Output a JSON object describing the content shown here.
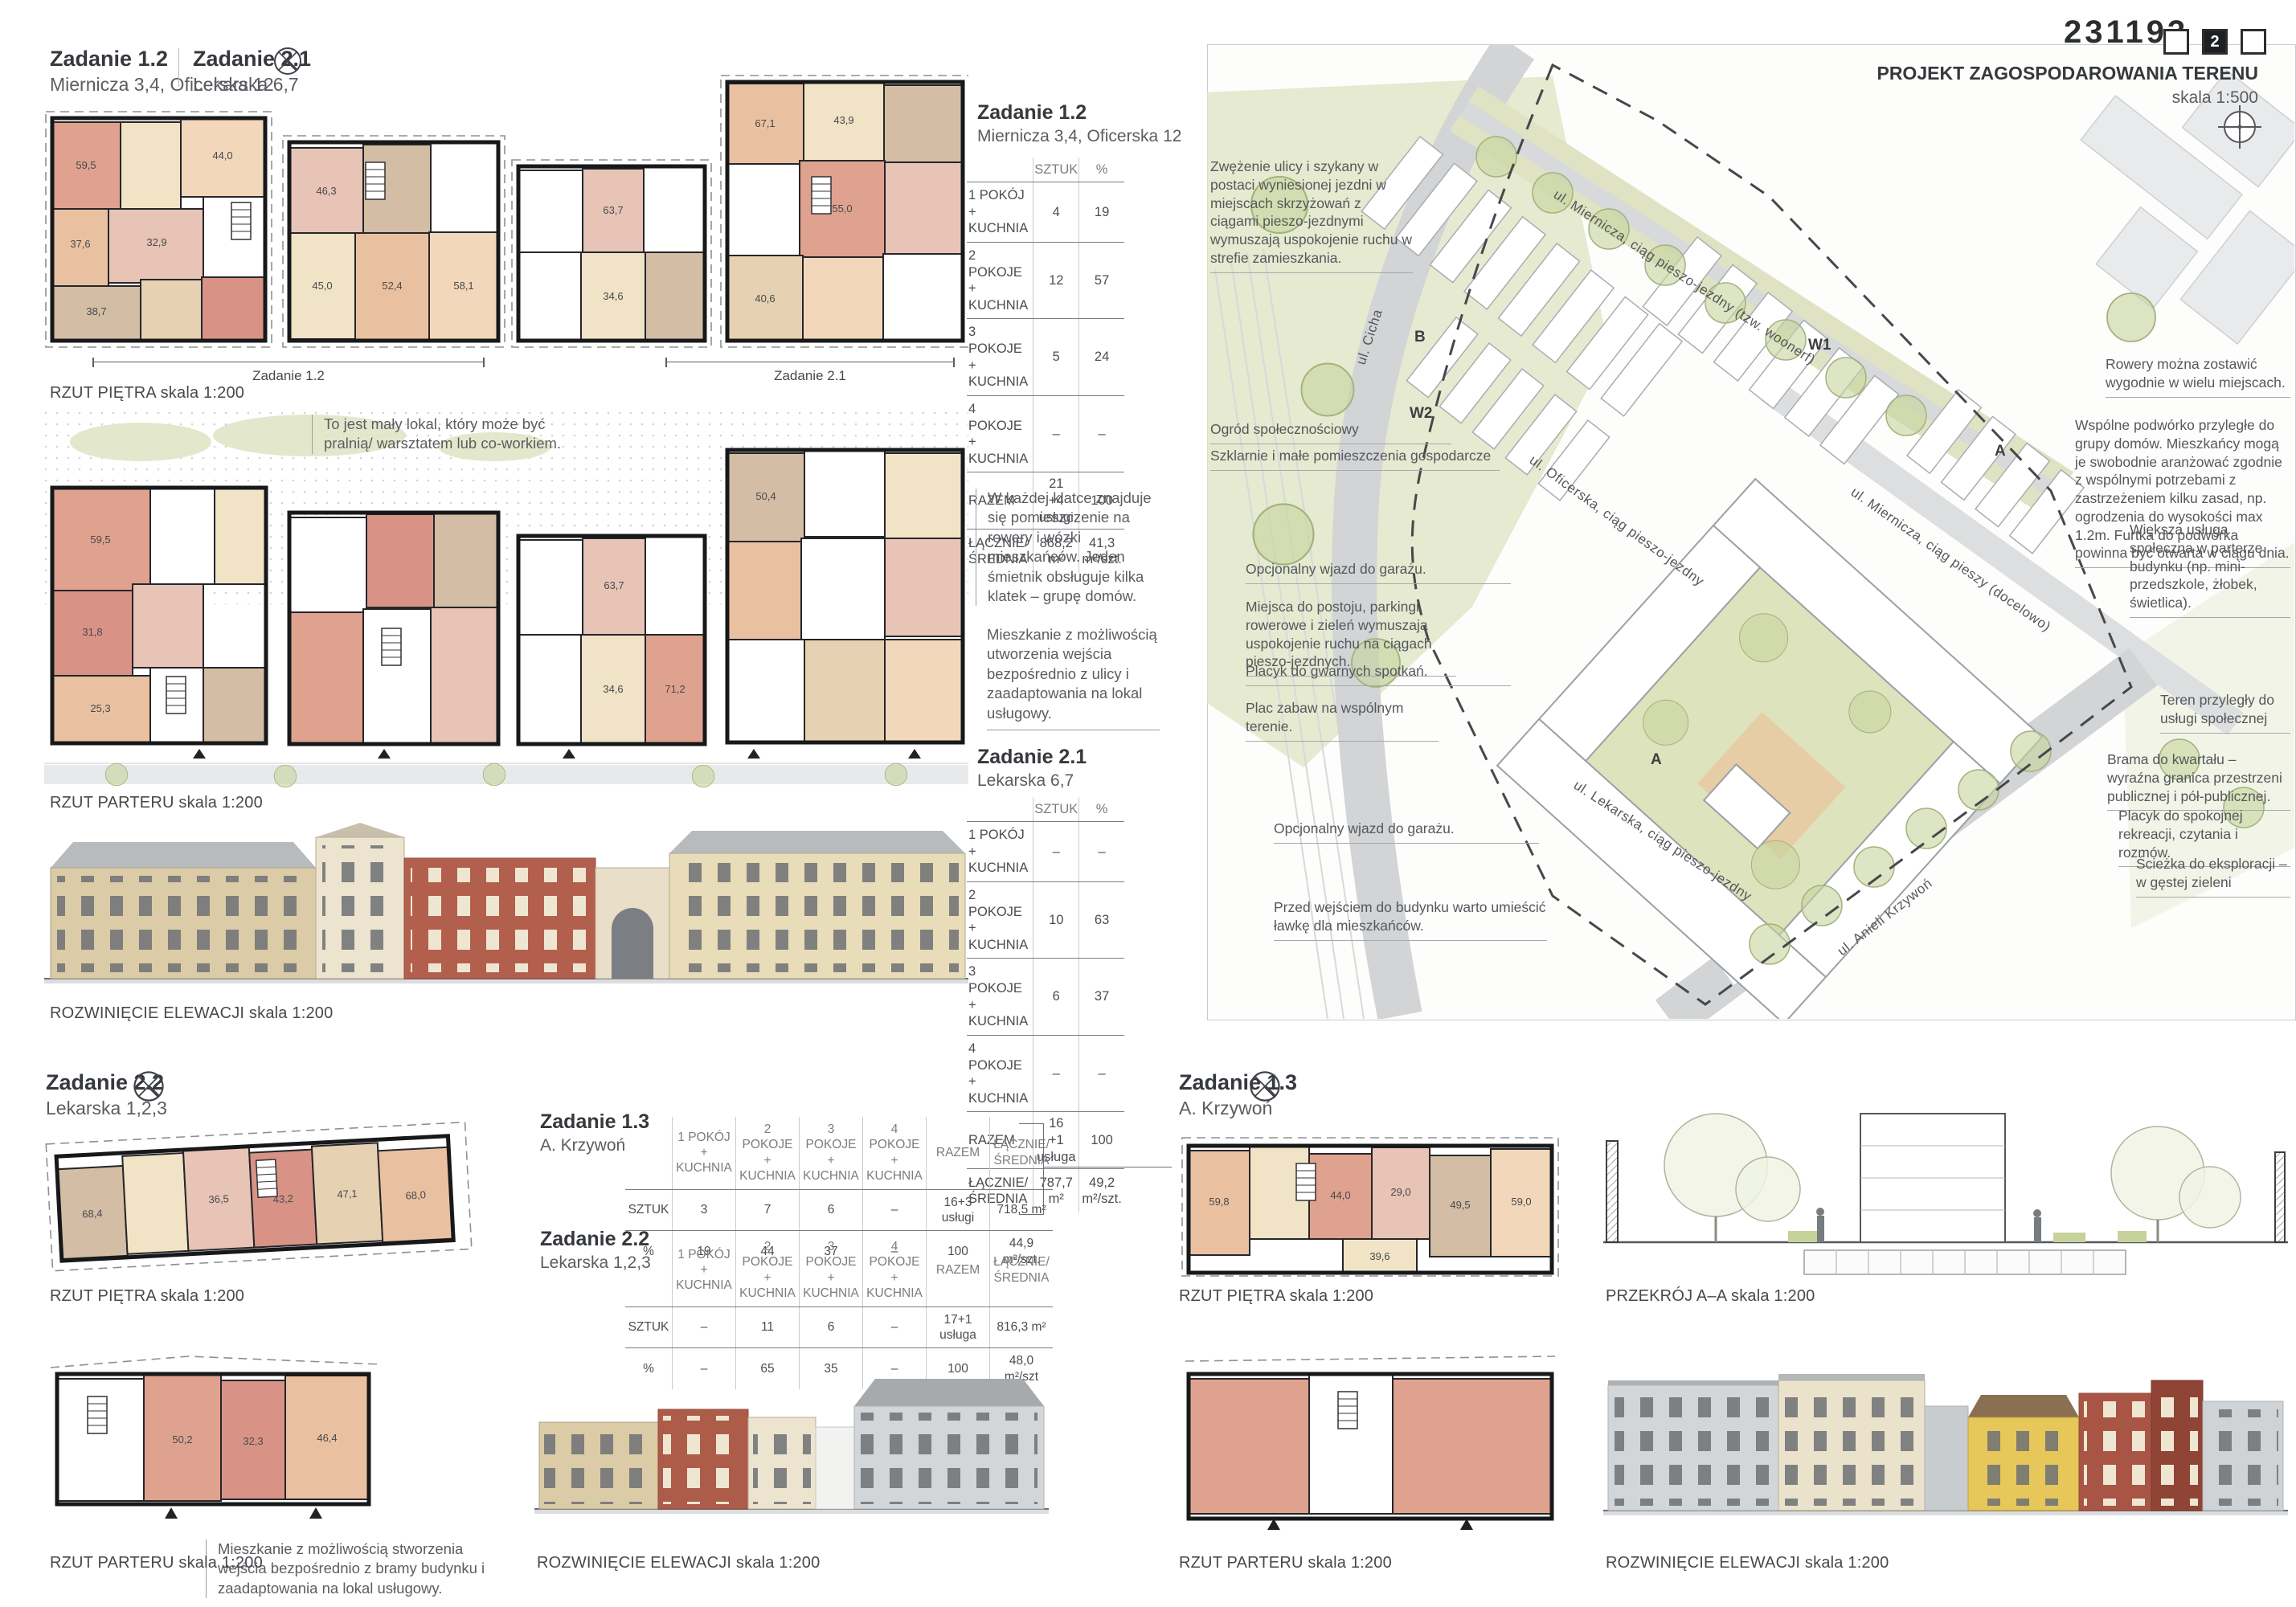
{
  "board": {
    "number": "231193",
    "page": "2"
  },
  "headers": {
    "z12": {
      "title": "Zadanie 1.2",
      "subtitle": "Miernicza 3,4, Oficerska 12"
    },
    "z21": {
      "title": "Zadanie 2.1",
      "subtitle": "Lekarska 6,7"
    },
    "z22": {
      "title": "Zadanie 2.2",
      "subtitle": "Lekarska 1,2,3"
    },
    "z13": {
      "title": "Zadanie 1.3",
      "subtitle": "A. Krzywoń"
    }
  },
  "captions": {
    "rzut_pietra": "RZUT PIĘTRA skala 1:200",
    "rzut_parteru": "RZUT PARTERU skala 1:200",
    "rozwiniecie": "ROZWINIĘCIE ELEWACJI skala 1:200",
    "przekroj": "PRZEKRÓJ A–A skala 1:200",
    "dim_z12": "Zadanie 1.2",
    "dim_z21": "Zadanie 2.1"
  },
  "notes": {
    "small_local": "To jest mały lokal, który może być pralnią/ warsztatem lub co-workiem.",
    "staircase": "W każdej klatce znajduje się pomieszczenie na rowery i wózki mieszkańców. Jeden śmietnik obsługuje kilka klatek – grupę domów.",
    "street_unit": "Mieszkanie z możliwością utworzenia wejścia bezpośrednio z ulicy i zaadaptowania na lokal usługowy.",
    "gate_unit": "Mieszkanie z możliwością stworzenia wejścia bezpośrednio z bramy budynku i zaadaptowania na lokal usługowy."
  },
  "site": {
    "title": "PROJEKT ZAGOSPODAROWANIA TERENU",
    "scale": "skala 1:500",
    "streets": {
      "cicha": "ul. Cicha",
      "miernicza_woonerf": "ul. Miernicza, ciąg pieszo-jezdny (tzw. woonerf)",
      "miernicza_pieszy": "ul. Miernicza, ciąg pieszy (docelowo)",
      "oficerska": "ul. Oficerska, ciąg pieszo-jezdny",
      "lekarska": "ul. Lekarska, ciąg pieszo-jezdny",
      "krzywon": "ul. Anieli Krzywoń"
    },
    "markers": {
      "w1": "W1",
      "w2": "W2",
      "b": "B",
      "a": "A"
    },
    "left_annotations": [
      "Zwężenie ulicy i szykany w postaci wyniesionej jezdni w miejscach skrzyżowań z ciągami pieszo-jezdnymi wymuszają uspokojenie ruchu w strefie zamieszkania.",
      "Ogród społecznościowy",
      "Szklarnie i małe pomieszczenia gospodarcze",
      "Opcjonalny wjazd do garażu.",
      "Miejsca do postoju, parkingi rowerowe i zieleń wymuszają uspokojenie ruchu na ciągach pieszo-jezdnych.",
      "Placyk do gwarnych spotkań.",
      "Plac zabaw na wspólnym terenie.",
      "Opcjonalny wjazd do garażu.",
      "Przed wejściem do budynku warto umieścić ławkę dla mieszkańców."
    ],
    "right_annotations": [
      "Rowery można zostawić wygodnie w wielu miejscach.",
      "Wspólne podwórko przyległe do grupy domów. Mieszkańcy mogą je swobodnie aranżować zgodnie z wspólnymi potrzebami z zastrzeżeniem kilku zasad, np. ogrodzenia do wysokości max 1.2m. Furtka do podwórka powinna być otwarta w ciągu dnia.",
      "Większa usługa społeczna w parterze budynku (np. mini-przedszkole, żłobek, świetlica).",
      "Teren przyległy do usługi społecznej",
      "Brama do kwartału – wyraźna granica przestrzeni publicznej i pół-publicznej.",
      "Placyk do spokojnej rekreacji, czytania i rozmów.",
      "Ścieżka do eksploracji – w gęstej zieleni"
    ]
  },
  "tables": {
    "z12": {
      "col_headers": [
        "SZTUK",
        "%"
      ],
      "rows": [
        {
          "label": "1 POKÓJ\n+ KUCHNIA",
          "sztuk": "4",
          "pct": "19"
        },
        {
          "label": "2 POKOJE\n+ KUCHNIA",
          "sztuk": "12",
          "pct": "57"
        },
        {
          "label": "3 POKOJE\n+ KUCHNIA",
          "sztuk": "5",
          "pct": "24"
        },
        {
          "label": "4 POKOJE\n+ KUCHNIA",
          "sztuk": "–",
          "pct": "–"
        },
        {
          "label": "RAZEM",
          "sztuk": "21\n+4 usługi",
          "pct": "100"
        },
        {
          "label": "ŁĄCZNIE/\nŚREDNIA",
          "sztuk": "868,2 m²",
          "pct": "41,3\nm²/szt."
        }
      ]
    },
    "z21": {
      "col_headers": [
        "SZTUK",
        "%"
      ],
      "rows": [
        {
          "label": "1 POKÓJ\n+ KUCHNIA",
          "sztuk": "–",
          "pct": "–"
        },
        {
          "label": "2 POKOJE\n+ KUCHNIA",
          "sztuk": "10",
          "pct": "63"
        },
        {
          "label": "3 POKOJE\n+ KUCHNIA",
          "sztuk": "6",
          "pct": "37"
        },
        {
          "label": "4 POKOJE\n+ KUCHNIA",
          "sztuk": "–",
          "pct": "–"
        },
        {
          "label": "RAZEM",
          "sztuk": "16\n+1 usługa",
          "pct": "100"
        },
        {
          "label": "ŁĄCZNIE/\nŚREDNIA",
          "sztuk": "787,7 m²",
          "pct": "49,2\nm²/szt."
        }
      ]
    },
    "z13": {
      "col_headers": [
        "1 POKÓJ\n+ KUCHNIA",
        "2 POKOJE\n+ KUCHNIA",
        "3 POKOJE\n+ KUCHNIA",
        "4 POKOJE\n+ KUCHNIA",
        "RAZEM",
        "ŁĄCZNIE/\nŚREDNIA"
      ],
      "rows": [
        {
          "label": "SZTUK",
          "values": [
            "3",
            "7",
            "6",
            "–",
            "16+3 usługi",
            "718,5 m²"
          ]
        },
        {
          "label": "%",
          "values": [
            "19",
            "44",
            "37",
            "–",
            "100",
            "44,9 m²/szt."
          ]
        }
      ]
    },
    "z22": {
      "col_headers": [
        "1 POKÓJ\n+ KUCHNIA",
        "2 POKOJE\n+ KUCHNIA",
        "3 POKOJE\n+ KUCHNIA",
        "4 POKOJE\n+ KUCHNIA",
        "RAZEM",
        "ŁĄCZNIE/\nŚREDNIA"
      ],
      "rows": [
        {
          "label": "SZTUK",
          "values": [
            "–",
            "11",
            "6",
            "–",
            "17+1 usługa",
            "816,3 m²"
          ]
        },
        {
          "label": "%",
          "values": [
            "–",
            "65",
            "35",
            "–",
            "100",
            "48,0 m²/szt"
          ]
        }
      ]
    }
  },
  "areas": {
    "pietro": [
      "59,5",
      "37,6",
      "44,0",
      "38,7",
      "32,9",
      "45,0",
      "52,4",
      "58,1",
      "63,7",
      "34,6",
      "67,1",
      "43,9",
      "55,0",
      "40,6",
      "46,3"
    ],
    "parter": [
      "59,5",
      "31,8",
      "25,3",
      "63,7",
      "34,6",
      "71,2",
      "50,4"
    ],
    "z22p": [
      "68,4",
      "36,5",
      "43,2",
      "47,1",
      "68,0"
    ],
    "z22g": [
      "50,2",
      "32,3",
      "46,4"
    ],
    "z13p": [
      "59,8",
      "44,0",
      "29,0",
      "49,5",
      "59,0",
      "39,6"
    ]
  }
}
